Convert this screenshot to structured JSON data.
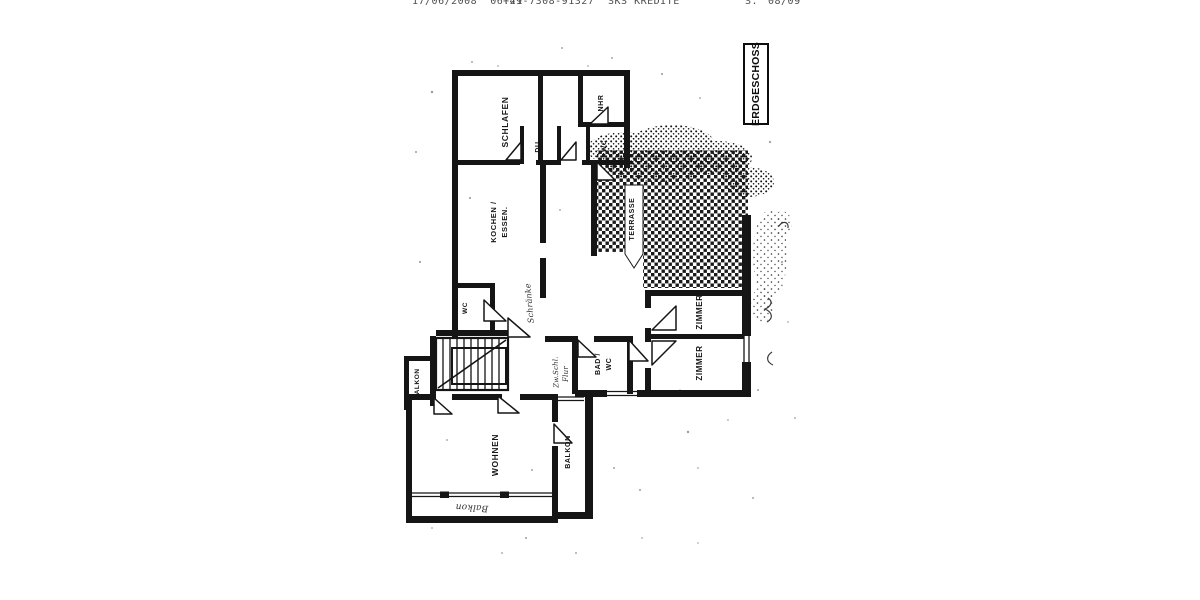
{
  "fax_header": {
    "datetime": "17/06/2008  06:21",
    "fax_number": "+49-7308-91327",
    "sender": "SKS KREDITE",
    "page_label": "S.",
    "page_number": "08/09"
  },
  "plan": {
    "floor_label": "ERDGESCHOSS",
    "rooms": {
      "schlafen": "SCHLAFEN",
      "nhr": "NHR",
      "du": "DU",
      "wc_top": "WC",
      "kochen_line1": "KOCHEN /",
      "kochen_line2": "ESSEN.",
      "wc_mid": "WC",
      "terrasse": "TERRASSE",
      "zimmer1": "ZIMMER",
      "zimmer2": "ZIMMER",
      "bad_line1": "BAD /",
      "bad_line2": "WC",
      "balkon_left": "BALKON",
      "balkon_right": "BALKON",
      "wohnen": "WOHNEN"
    },
    "annotations": {
      "schraenke": "Schränke",
      "zwschl": "Zw.Schl.",
      "flur": "Flur",
      "balkon_hand": "Balkon"
    },
    "colors": {
      "wall": "#151515",
      "ink": "#161616",
      "scan_gray": "#4e4e4e"
    }
  }
}
